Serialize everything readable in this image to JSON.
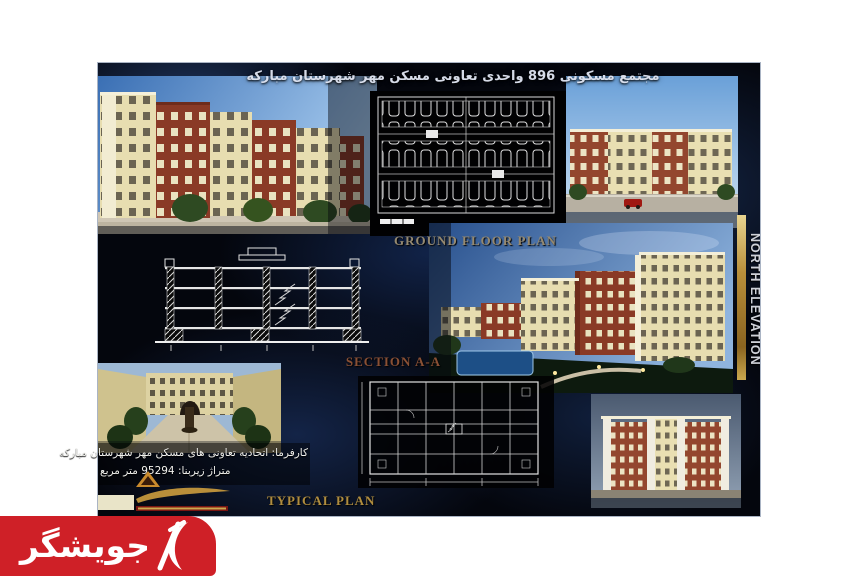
{
  "board": {
    "title": "مجتمع مسکونی 896 واحدی تعاونی مسکن مهر شهرستان مبارکه",
    "labels": {
      "ground_floor_plan": "GROUND FLOOR PLAN",
      "section": "SECTION A-A",
      "typical_plan": "TYPICAL PLAN",
      "north_elevation": "NORTH ELEVATION"
    },
    "client_info": {
      "line1": "کارفرما: اتحادیه تعاونی های مسکن مهر شهرستان مبارکه",
      "line2": "متراژ زیربنا: 95294 متر مربع"
    }
  },
  "watermark": {
    "text": "جویشگر",
    "logo": "jooyeshgar-mark",
    "background_color": "#cf2027",
    "text_color": "#ffffff"
  },
  "colors": {
    "board_background": "#04060d",
    "smoke_blue": "#2d5cae",
    "brick": "#8a3a26",
    "cream": "#e8dfb4",
    "sky_blue": "#6aa0d8",
    "gold_label": "#b08d3e",
    "tan_label": "#958970",
    "section_label": "#8a5034",
    "plan_line": "#e8e8e8",
    "car_red": "#a01812"
  }
}
